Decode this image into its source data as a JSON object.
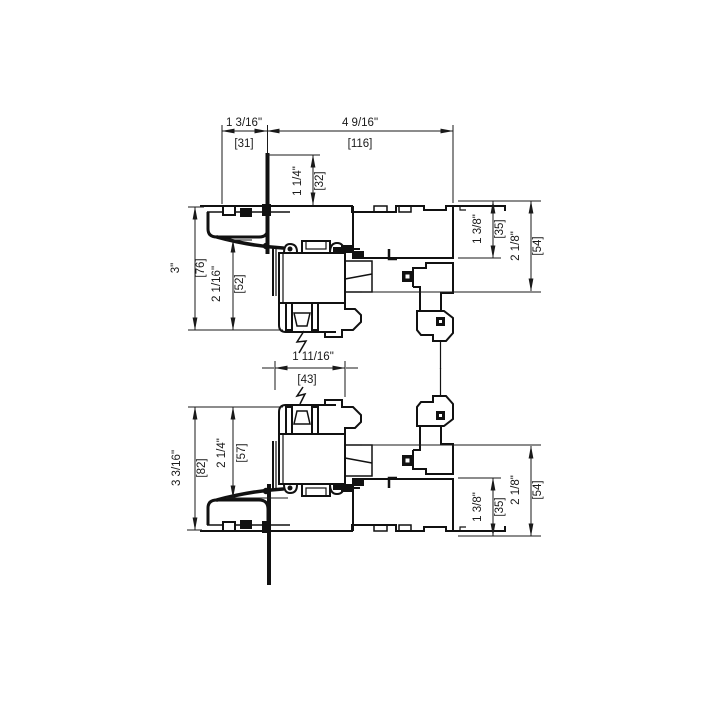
{
  "drawing": {
    "type": "window-frame-cross-section-detail",
    "colors": {
      "line": "#1a1a1a",
      "background": "#ffffff"
    },
    "dims": {
      "top_offset": {
        "in": "1 3/16\"",
        "mm": "[31]"
      },
      "frame_width": {
        "in": "4 9/16\"",
        "mm": "[116]"
      },
      "head_inset": {
        "in": "1 1/4\"",
        "mm": "[32]"
      },
      "upper_overall": {
        "in": "3\"",
        "mm": "[76]"
      },
      "upper_sash": {
        "in": "2 1/16\"",
        "mm": "[52]"
      },
      "upper_glass_pocket": {
        "in": "1 3/8\"",
        "mm": "[35]"
      },
      "upper_track": {
        "in": "2 1/8\"",
        "mm": "[54]"
      },
      "interlock_gap": {
        "in": "1 11/16\"",
        "mm": "[43]"
      },
      "lower_sash": {
        "in": "2 1/4\"",
        "mm": "[57]"
      },
      "lower_overall": {
        "in": "3 3/16\"",
        "mm": "[82]"
      },
      "lower_glass_pocket": {
        "in": "1 3/8\"",
        "mm": "[35]"
      },
      "lower_track": {
        "in": "2 1/8\"",
        "mm": "[54]"
      }
    }
  }
}
